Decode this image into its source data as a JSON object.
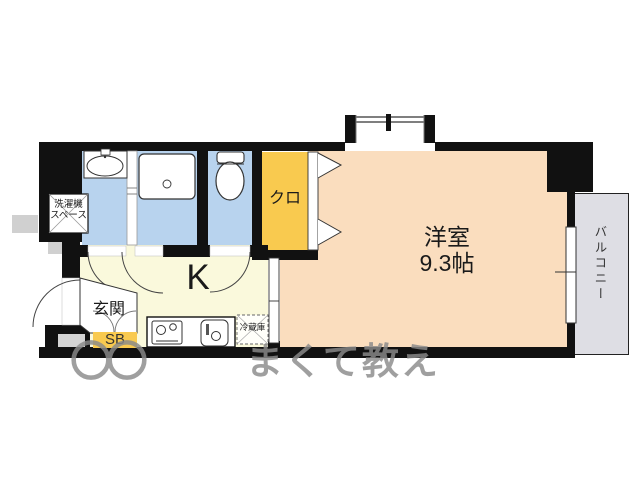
{
  "floorplan": {
    "rooms": {
      "main_room": {
        "name": "洋室",
        "size": "9.3帖"
      },
      "kitchen": {
        "label": "K"
      },
      "entrance": {
        "label": "玄関"
      },
      "closet": {
        "label": "クロ"
      },
      "shoe_box": {
        "label": "SB"
      },
      "balcony": {
        "label": "バルコニー"
      }
    },
    "fixtures": {
      "washer_space": {
        "line1": "洗濯機",
        "line2": "スペース"
      },
      "refrigerator": {
        "label": "冷蔵庫"
      }
    },
    "watermark": {
      "left": "〇〇",
      "right": "まくて教え"
    },
    "colors": {
      "wall": "#111111",
      "main_room": "#FADDBE",
      "kitchen": "#FAF9DC",
      "wet_area": "#B8D3EE",
      "closet": "#F9CA4F",
      "balcony": "#DEDEE4",
      "porch_gray": "#D4D4D4",
      "watermark": "#8A8A8A"
    }
  }
}
